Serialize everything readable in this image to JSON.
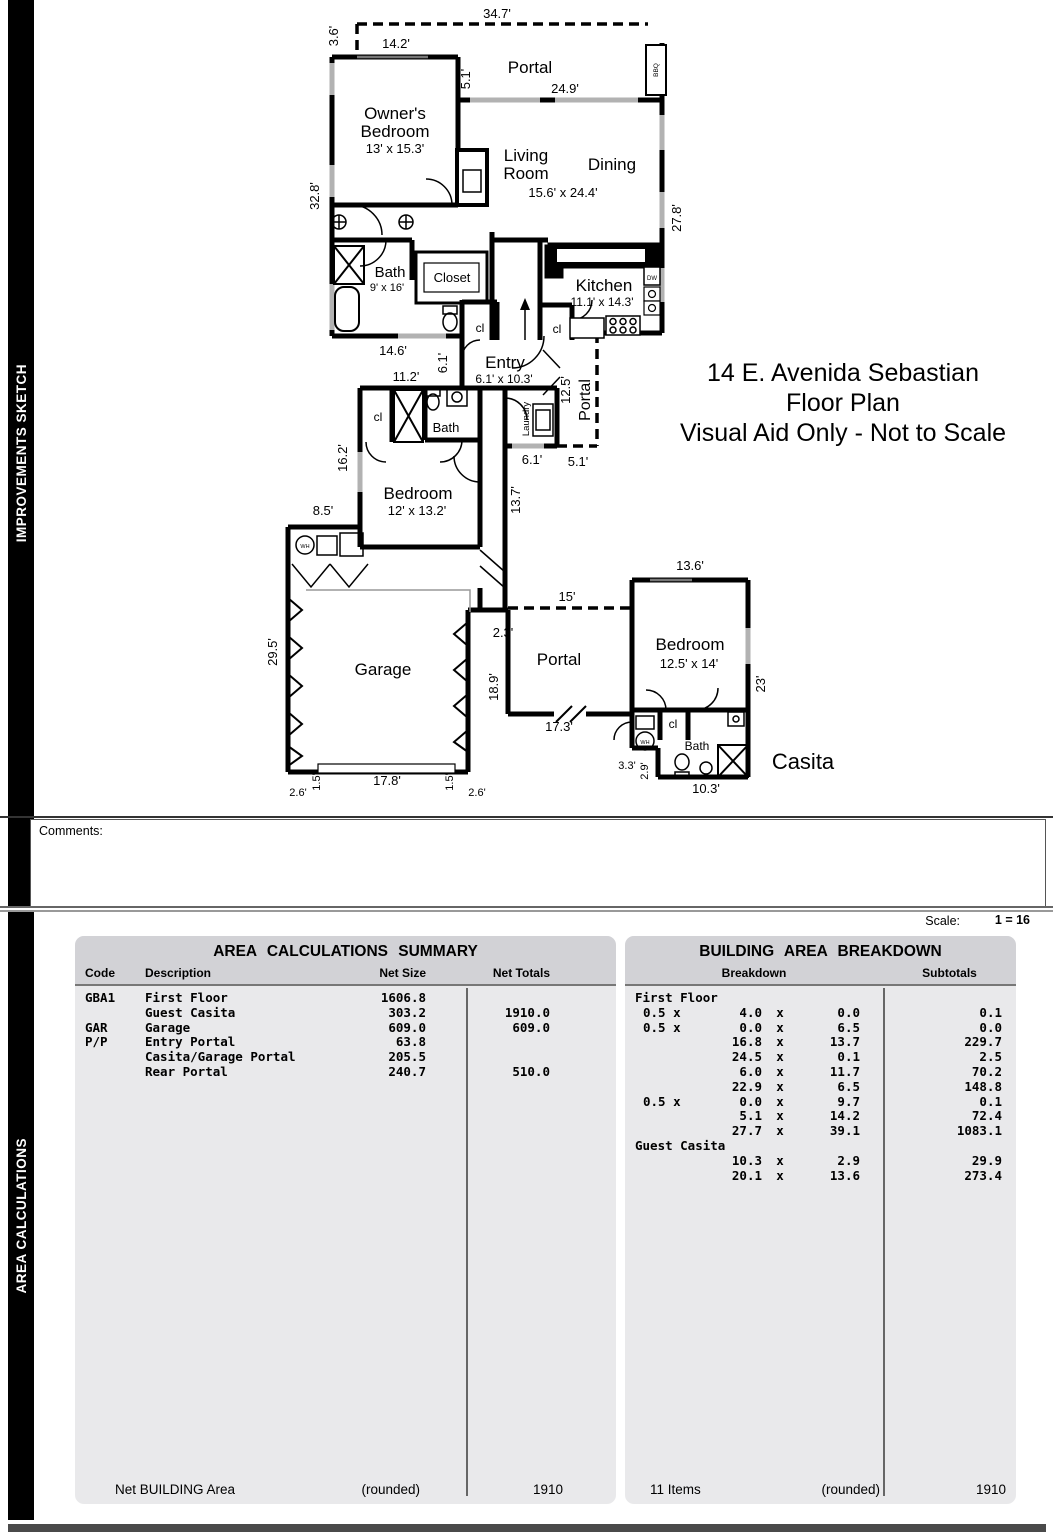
{
  "sidebar": {
    "improvements": "IMPROVEMENTS SKETCH",
    "area_calc": "AREA CALCULATIONS"
  },
  "title": {
    "l1": "14 E. Avenida Sebastian",
    "l2": "Floor Plan",
    "l3": "Visual Aid Only - Not to Scale"
  },
  "comments": {
    "label": "Comments:"
  },
  "scale": {
    "label": "Scale:",
    "value": "1 = 16"
  },
  "plan": {
    "labels": {
      "t347": "34.7'",
      "t36": "3.6'",
      "t142": "14.2'",
      "portal_top": "Portal",
      "t51a": "5.1'",
      "t249": "24.9'",
      "bbq": "BBQ",
      "own1": "Owner's",
      "own2": "Bedroom",
      "own_d": "13' x 15.3'",
      "liv1": "Living",
      "liv2": "Room",
      "dining": "Dining",
      "livd": "15.6' x 24.4'",
      "t328": "32.8'",
      "t278": "27.8'",
      "bath1": "Bath",
      "bath1d": "9' x 16'",
      "closet": "Closet",
      "kitchen": "Kitchen",
      "kitchend": "11.1' x 14.3'",
      "dw": "DW",
      "cl1": "cl",
      "cl2": "cl",
      "t146": "14.6'",
      "t61a": "6.1'",
      "entry": "Entry",
      "entryd": "6.1' x 10.3'",
      "t125": "12.5'",
      "portal_r": "Portal",
      "t112": "11.2'",
      "cl3": "cl",
      "bath2": "Bath",
      "laundry": "Laundry",
      "t162": "16.2'",
      "bed2": "Bedroom",
      "bed2d": "12' x 13.2'",
      "t61b": "6.1'",
      "t51b": "5.1'",
      "t137": "13.7'",
      "t85": "8.5'",
      "wh1": "WH",
      "t15": "15'",
      "t23j": "2.3'",
      "garage": "Garage",
      "portal_m": "Portal",
      "t189": "18.9'",
      "t173": "17.3'",
      "t295": "29.5'",
      "t178": "17.8'",
      "t15l": "1.5'",
      "t15r": "1.5'",
      "t26l": "2.6'",
      "t26r": "2.6'",
      "t136": "13.6'",
      "bed3": "Bedroom",
      "bed3d": "12.5' x 14'",
      "t23": "23'",
      "cl4": "cl",
      "bath3": "Bath",
      "wh2": "WH",
      "t33": "3.3'",
      "t29": "2.9'",
      "t103": "10.3'",
      "casita": "Casita"
    }
  },
  "tables": {
    "summary": {
      "title": "AREA CALCULATIONS SUMMARY",
      "headers": {
        "code": "Code",
        "description": "Description",
        "net_size": "Net Size",
        "net_totals": "Net Totals"
      },
      "rows": [
        {
          "code": "GBA1",
          "desc": "First Floor",
          "size": "1606.8",
          "total": ""
        },
        {
          "code": "",
          "desc": "Guest Casita",
          "size": "303.2",
          "total": "1910.0"
        },
        {
          "code": "GAR",
          "desc": "Garage",
          "size": "609.0",
          "total": "609.0"
        },
        {
          "code": "P/P",
          "desc": "Entry Portal",
          "size": "63.8",
          "total": ""
        },
        {
          "code": "",
          "desc": "Casita/Garage Portal",
          "size": "205.5",
          "total": ""
        },
        {
          "code": "",
          "desc": "Rear Portal",
          "size": "240.7",
          "total": "510.0"
        }
      ],
      "footer": {
        "label": "Net BUILDING Area",
        "rounded": "(rounded)",
        "total": "1910"
      }
    },
    "breakdown": {
      "title": "BUILDING AREA BREAKDOWN",
      "headers": {
        "breakdown": "Breakdown",
        "subtotals": "Subtotals"
      },
      "mult": "x",
      "rows": [
        {
          "label": "First Floor"
        },
        {
          "prefix": "0.5 x",
          "a": "4.0",
          "b": "0.0",
          "sub": "0.1"
        },
        {
          "prefix": "0.5 x",
          "a": "0.0",
          "b": "6.5",
          "sub": "0.0"
        },
        {
          "prefix": "",
          "a": "16.8",
          "b": "13.7",
          "sub": "229.7"
        },
        {
          "prefix": "",
          "a": "24.5",
          "b": "0.1",
          "sub": "2.5"
        },
        {
          "prefix": "",
          "a": "6.0",
          "b": "11.7",
          "sub": "70.2"
        },
        {
          "prefix": "",
          "a": "22.9",
          "b": "6.5",
          "sub": "148.8"
        },
        {
          "prefix": "0.5 x",
          "a": "0.0",
          "b": "9.7",
          "sub": "0.1"
        },
        {
          "prefix": "",
          "a": "5.1",
          "b": "14.2",
          "sub": "72.4"
        },
        {
          "prefix": "",
          "a": "27.7",
          "b": "39.1",
          "sub": "1083.1"
        },
        {
          "label": "Guest Casita"
        },
        {
          "prefix": "",
          "a": "10.3",
          "b": "2.9",
          "sub": "29.9"
        },
        {
          "prefix": "",
          "a": "20.1",
          "b": "13.6",
          "sub": "273.4"
        }
      ],
      "footer": {
        "label": "11 Items",
        "rounded": "(rounded)",
        "total": "1910"
      }
    }
  }
}
